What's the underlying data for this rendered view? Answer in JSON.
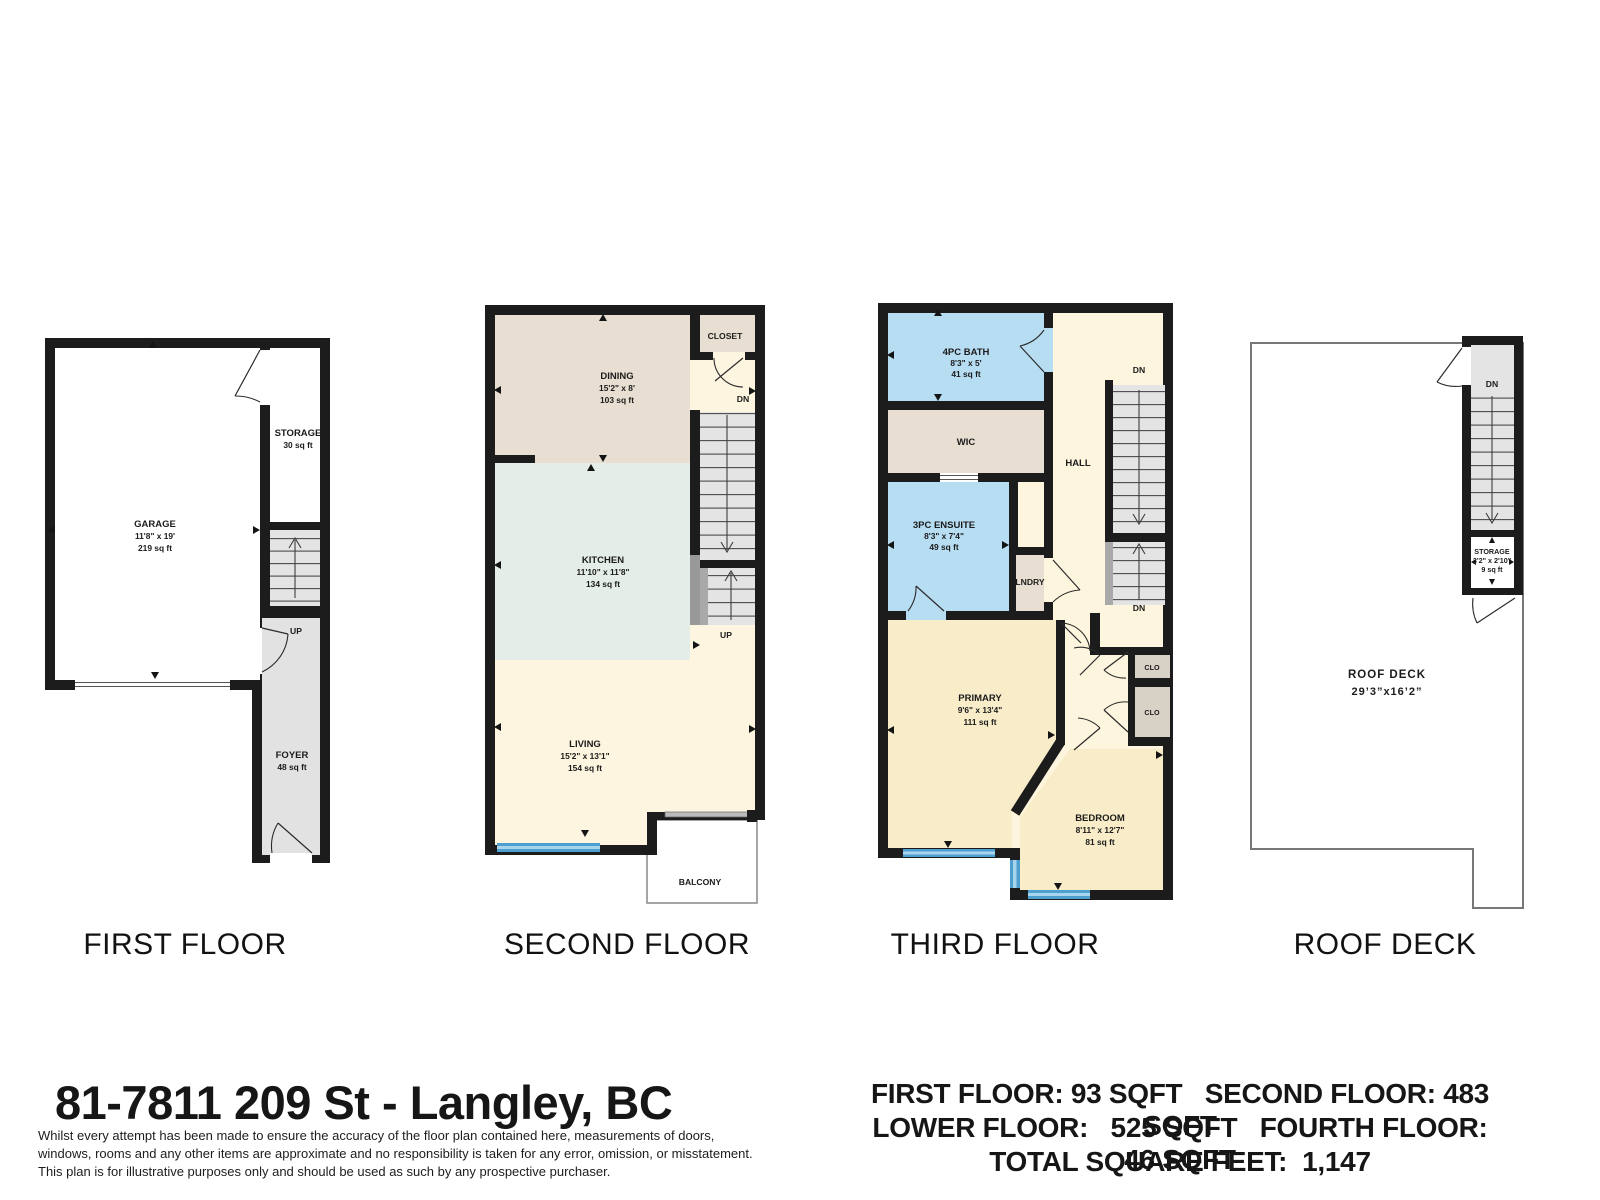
{
  "colors": {
    "wall": "#1c1c1c",
    "dining_tan": "#e8dfd2",
    "kitchen_mint": "#e4ede7",
    "living_cream": "#fdf5df",
    "bedroom_yellow": "#f9edc9",
    "bath_blue": "#b7ddf3",
    "stair_gray": "#e4e4e4",
    "foyer_gray": "#e2e2e2",
    "closet_tan": "#d8d1c6",
    "window_blue": "#4d9fd0"
  },
  "floors": {
    "first": {
      "title": "FIRST FLOOR",
      "garage_name": "GARAGE",
      "garage_dims": "11'8\" x 19'",
      "garage_area": "219 sq ft",
      "storage_name": "STORAGE",
      "storage_area": "30 sq ft",
      "up_label": "UP",
      "foyer_name": "FOYER",
      "foyer_area": "48 sq ft"
    },
    "second": {
      "title": "SECOND FLOOR",
      "closet_label": "CLOSET",
      "dn_label": "DN",
      "up_label": "UP",
      "dining_name": "DINING",
      "dining_dims": "15'2\" x 8'",
      "dining_area": "103 sq ft",
      "kitchen_name": "KITCHEN",
      "kitchen_dims": "11'10\" x 11'8\"",
      "kitchen_area": "134 sq ft",
      "living_name": "LIVING",
      "living_dims": "15'2\" x 13'1\"",
      "living_area": "154 sq ft",
      "balcony_label": "BALCONY"
    },
    "third": {
      "title": "THIRD FLOOR",
      "bath_name": "4PC BATH",
      "bath_dims": "8'3\" x 5'",
      "bath_area": "41 sq ft",
      "wic_label": "WIC",
      "ensuite_name": "3PC ENSUITE",
      "ensuite_dims": "8'3\" x 7'4\"",
      "ensuite_area": "49 sq ft",
      "lndry_label": "LNDRY",
      "hall_label": "HALL",
      "dn_top_label": "DN",
      "dn_bottom_label": "DN",
      "clo_top_label": "CLO",
      "clo_bottom_label": "CLO",
      "primary_name": "PRIMARY",
      "primary_dims": "9'6\" x 13'4\"",
      "primary_area": "111 sq ft",
      "bedroom_name": "BEDROOM",
      "bedroom_dims": "8'11\" x 12'7\"",
      "bedroom_area": "81 sq ft"
    },
    "roof": {
      "title": "ROOF DECK",
      "dn_label": "DN",
      "storage_name": "STORAGE",
      "storage_dims": "3'2\" x 2'10\"",
      "storage_area": "9 sq ft",
      "deck_name": "ROOF DECK",
      "deck_dims": "29’3”x16’2”"
    }
  },
  "footer": {
    "address": "81-7811 209 St -  Langley, BC",
    "disclaimer_line1": "Whilst every attempt has been made to ensure the accuracy of the floor plan contained here, measurements of doors,",
    "disclaimer_line2": "windows, rooms and any other items are approximate and no responsibility is taken for any error, omission, or misstatement.",
    "disclaimer_line3": "This plan is for illustrative purposes only and should be used as such by any prospective purchaser.",
    "summary_line1": "FIRST FLOOR: 93 SQFT   SECOND FLOOR: 483 SQFT",
    "summary_line2": "LOWER FLOOR:   525 SQFT   FOURTH FLOOR: 46 SQFT",
    "summary_line3": "TOTAL SQUARE FEET:  1,147"
  }
}
